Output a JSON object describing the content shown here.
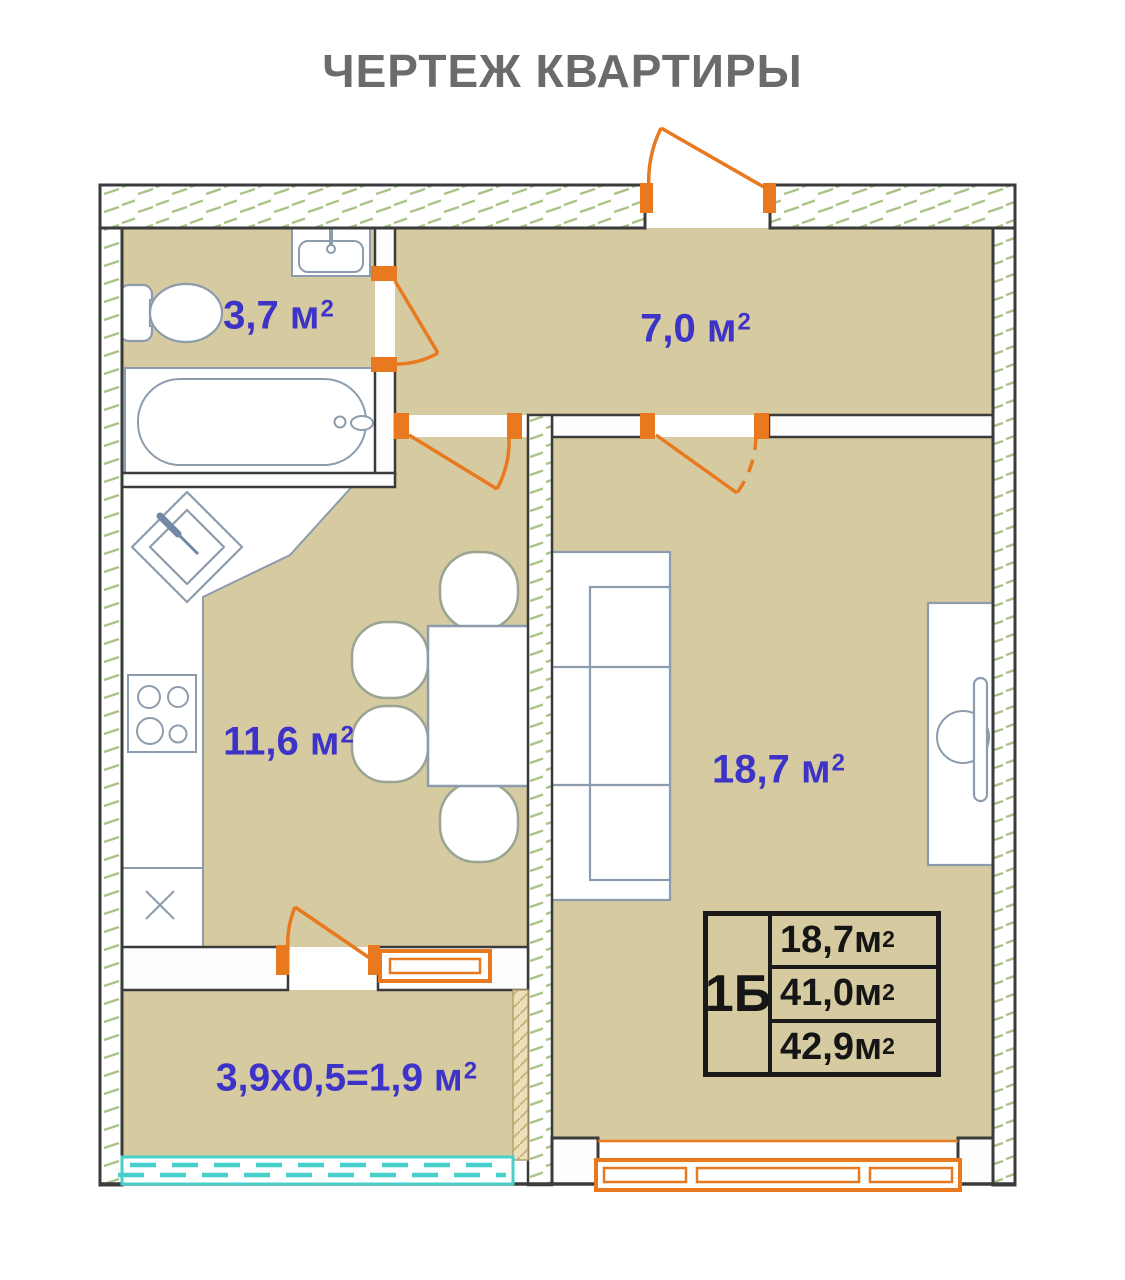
{
  "title": "ЧЕРТЕЖ КВАРТИРЫ",
  "rooms": {
    "bathroom": {
      "label": "3,7 м",
      "sup": "2"
    },
    "hallway": {
      "label": "7,0 м",
      "sup": "2"
    },
    "kitchen": {
      "label": "11,6 м",
      "sup": "2"
    },
    "living": {
      "label": "18,7 м",
      "sup": "2"
    },
    "balcony": {
      "label": "3,9x0,5=1,9 м",
      "sup": "2"
    }
  },
  "info_table": {
    "type_label": "1Б",
    "rows": [
      {
        "label": "18,7м",
        "sup": "2"
      },
      {
        "label": "41,0м",
        "sup": "2"
      },
      {
        "label": "42,9м",
        "sup": "2"
      }
    ]
  },
  "colors": {
    "floor_tan": "#d6caa1",
    "wall_line": "#3b3b3b",
    "hatch_green": "#a9c487",
    "door_orange": "#e8791f",
    "furniture_stroke": "#8d9cad",
    "label_blue": "#3d33c6",
    "railing_teal": "#45d0cb",
    "title_gray": "#6b6b6b",
    "table_text": "#151515"
  }
}
